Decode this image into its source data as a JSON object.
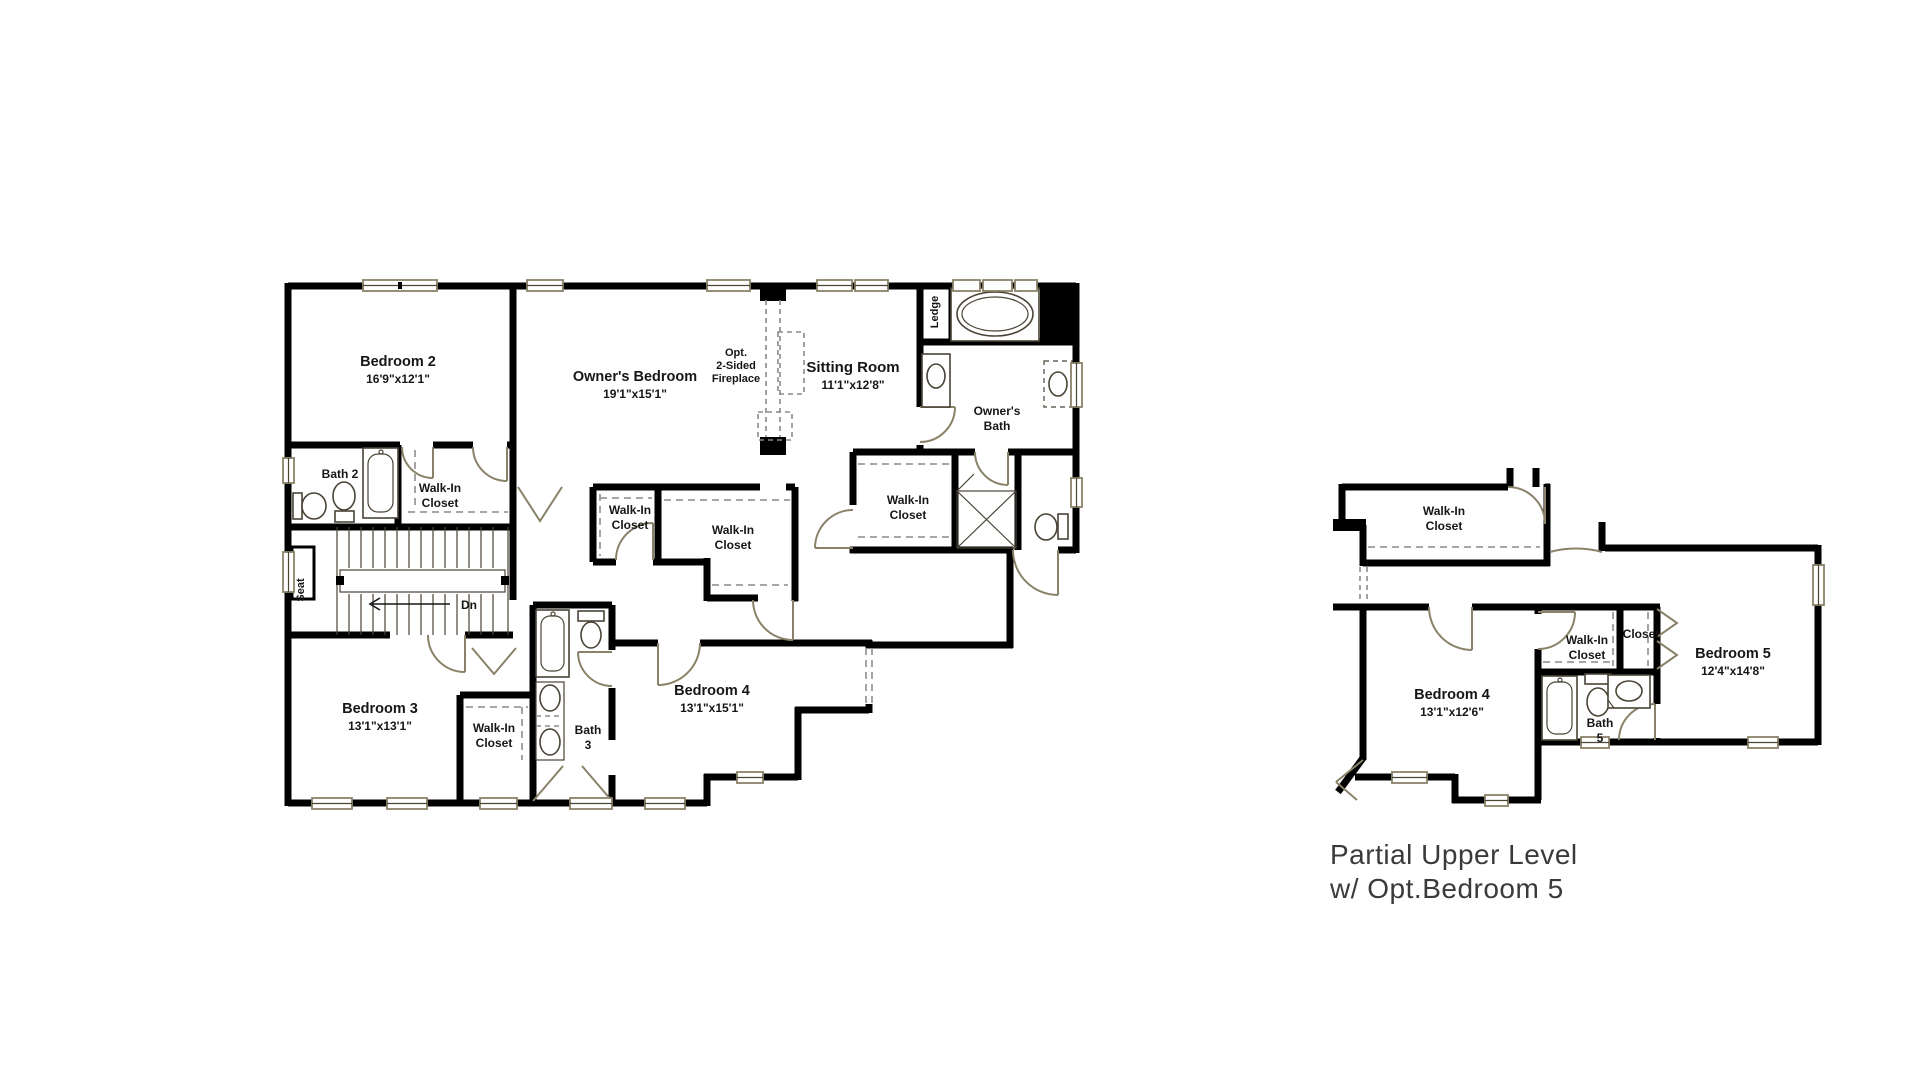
{
  "caption": {
    "line1": "Partial Upper Level",
    "line2": "w/ Opt.Bedroom 5"
  },
  "colors": {
    "wall": "#000000",
    "fixture_tan": "#8a8268",
    "dash_gray": "#9a9a9a",
    "text": "#161616",
    "caption_text": "#3a3a3a",
    "background": "#ffffff"
  },
  "fixture_glyphs": [
    "bathtub-icon",
    "toilet-icon",
    "sink-icon",
    "shower-icon",
    "stairs-icon",
    "door-arc-icon",
    "window-icon",
    "closet-rod-dash-icon"
  ],
  "plan1": {
    "rooms": {
      "bedroom2": {
        "name": "Bedroom 2",
        "dims": "16'9\"x12'1\""
      },
      "owners_bedroom": {
        "name": "Owner's Bedroom",
        "dims": "19'1\"x15'1\""
      },
      "sitting_room": {
        "name": "Sitting Room",
        "dims": "11'1\"x12'8\""
      },
      "bedroom3": {
        "name": "Bedroom 3",
        "dims": "13'1\"x13'1\""
      },
      "bedroom4": {
        "name": "Bedroom 4",
        "dims": "13'1\"x15'1\""
      },
      "bath2": {
        "name": "Bath 2"
      },
      "bath3": {
        "l1": "Bath",
        "l2": "3"
      },
      "owners_bath": {
        "l1": "Owner's",
        "l2": "Bath"
      },
      "wic_bedroom2": {
        "l1": "Walk-In",
        "l2": "Closet"
      },
      "wic_hall_small": {
        "l1": "Walk-In",
        "l2": "Closet"
      },
      "wic_hall_large": {
        "l1": "Walk-In",
        "l2": "Closet"
      },
      "wic_owner": {
        "l1": "Walk-In",
        "l2": "Closet"
      },
      "wic_bedroom3": {
        "l1": "Walk-In",
        "l2": "Closet"
      }
    },
    "annotations": {
      "ledge": "Ledge",
      "seat": "Seat",
      "dn": "Dn",
      "fireplace_l1": "Opt.",
      "fireplace_l2": "2-Sided",
      "fireplace_l3": "Fireplace"
    }
  },
  "plan2": {
    "rooms": {
      "wic_top": {
        "l1": "Walk-In",
        "l2": "Closet"
      },
      "bedroom4": {
        "name": "Bedroom 4",
        "dims": "13'1\"x12'6\""
      },
      "wic_bath": {
        "l1": "Walk-In",
        "l2": "Closet"
      },
      "closet": {
        "name": "Closet"
      },
      "bath5": {
        "l1": "Bath",
        "l2": "5"
      },
      "bedroom5": {
        "name": "Bedroom 5",
        "dims": "12'4\"x14'8\""
      }
    }
  }
}
